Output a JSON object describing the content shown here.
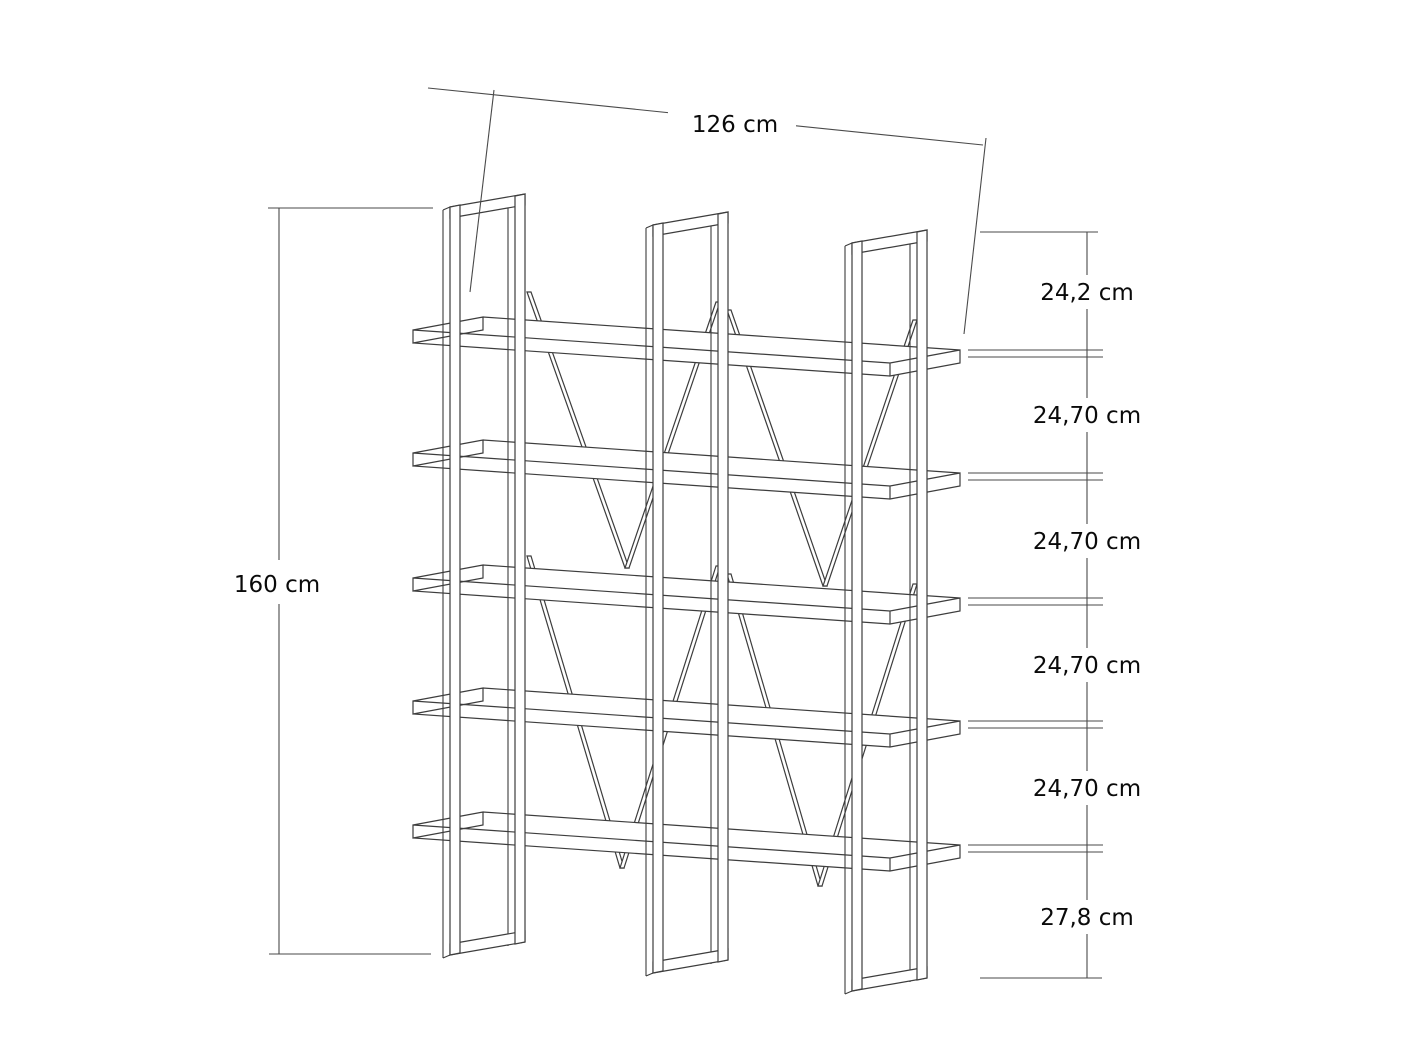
{
  "diagram": {
    "kind": "furniture-dimension-drawing",
    "subject": "Five-shelf bookcase with three vertical side frames and cross-braced back",
    "units": "cm",
    "width_label": "126 cm",
    "height_label": "160 cm",
    "right_spacings": [
      {
        "label": "24,2 cm"
      },
      {
        "label": "24,70 cm"
      },
      {
        "label": "24,70 cm"
      },
      {
        "label": "24,70 cm"
      },
      {
        "label": "24,70 cm"
      },
      {
        "label": "27,8 cm"
      }
    ],
    "colors": {
      "background": "#ffffff",
      "drawing_line": "#3d3d3d",
      "dimension_line": "#4a4a4a",
      "text": "#0a0a0a"
    }
  }
}
